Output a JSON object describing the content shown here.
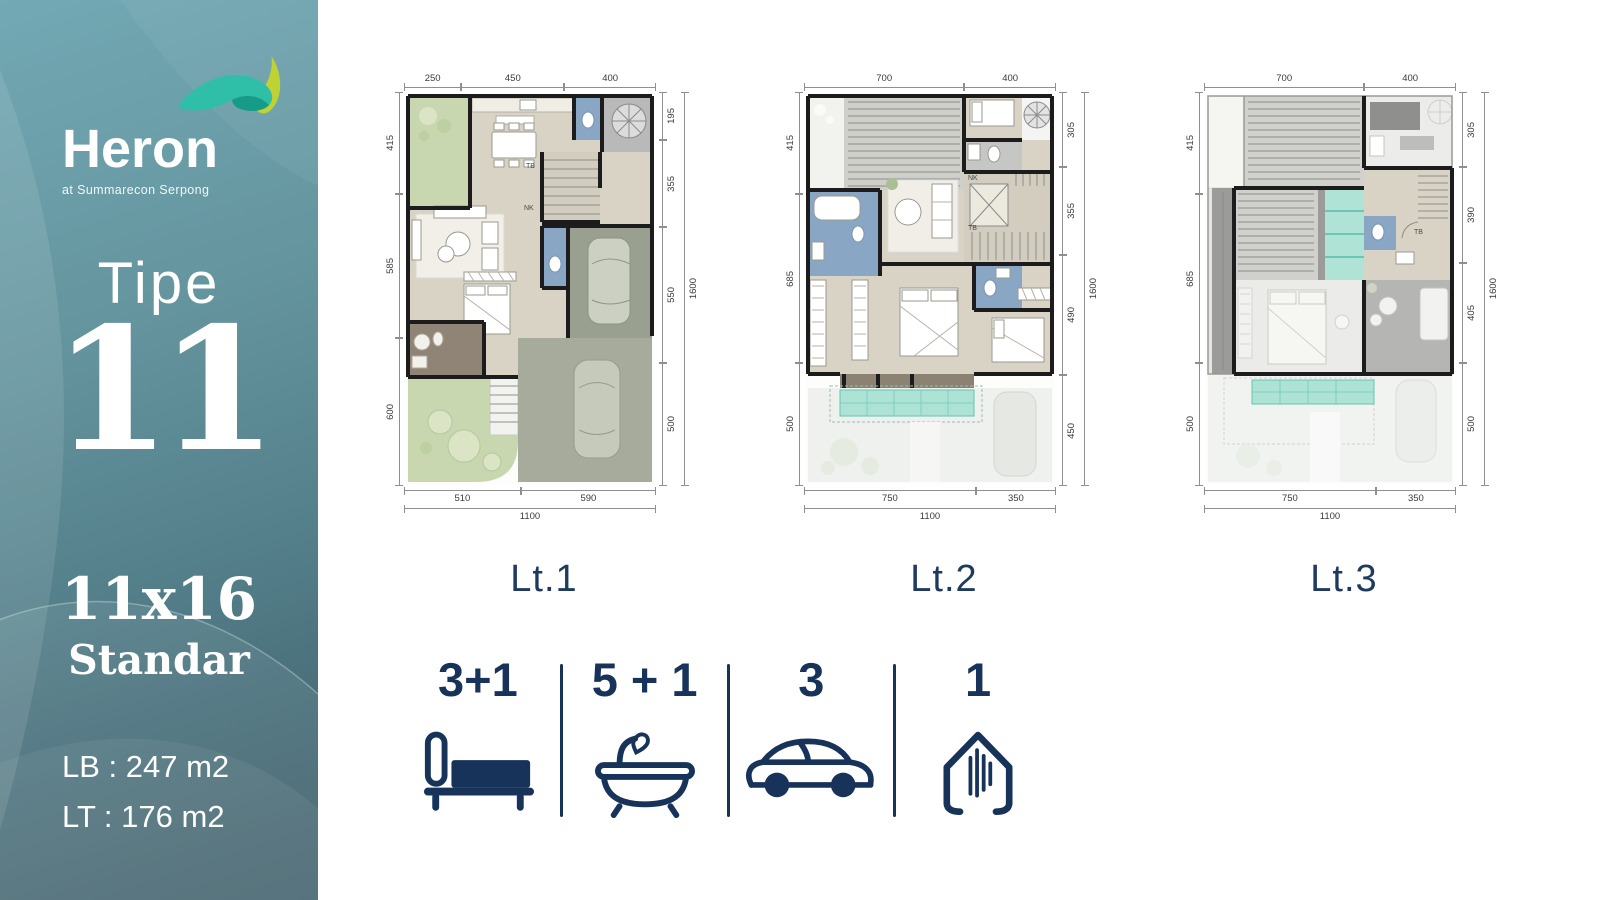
{
  "brand": {
    "name": "Heron",
    "tagline": "at Summarecon Serpong"
  },
  "sidebar": {
    "type_label": "Tipe",
    "type_number": "11",
    "size": "11x16",
    "variant": "Standar",
    "building_area": "LB : 247 m2",
    "land_area": "LT : 176 m2"
  },
  "colors": {
    "brand_teal": "#5a8791",
    "accent_navy": "#17335a",
    "pool_teal": "#ade3d4",
    "garden_green": "#c9d7b1"
  },
  "plans": [
    {
      "label": "Lt.1",
      "dims": {
        "top": [
          "250",
          "450",
          "400"
        ],
        "left": [
          "415",
          "585",
          "600"
        ],
        "right": [
          "195",
          "355",
          "550",
          "500"
        ],
        "right_total": "1600",
        "bottom": [
          "510",
          "590"
        ],
        "bottom_total": "1100"
      },
      "stairs": {
        "upper": "TB",
        "lower": "NK"
      }
    },
    {
      "label": "Lt.2",
      "dims": {
        "top": [
          "700",
          "400"
        ],
        "left": [
          "415",
          "685",
          "500"
        ],
        "right": [
          "305",
          "355",
          "490",
          "450"
        ],
        "right_total": "1600",
        "bottom": [
          "750",
          "350"
        ],
        "bottom_total": "1100"
      },
      "stairs": {
        "upper": "NK",
        "lower": "TB"
      }
    },
    {
      "label": "Lt.3",
      "dims": {
        "top": [
          "700",
          "400"
        ],
        "left": [
          "415",
          "685",
          "500"
        ],
        "right": [
          "305",
          "390",
          "405",
          "500"
        ],
        "right_total": "1600",
        "bottom": [
          "750",
          "350"
        ],
        "bottom_total": "1100"
      },
      "stairs": {
        "upper": "TB",
        "lower": ""
      }
    }
  ],
  "features": [
    {
      "name": "bedrooms",
      "count": "3+1"
    },
    {
      "name": "bathrooms",
      "count": "5 + 1"
    },
    {
      "name": "carports",
      "count": "3"
    },
    {
      "name": "house",
      "count": "1"
    }
  ]
}
